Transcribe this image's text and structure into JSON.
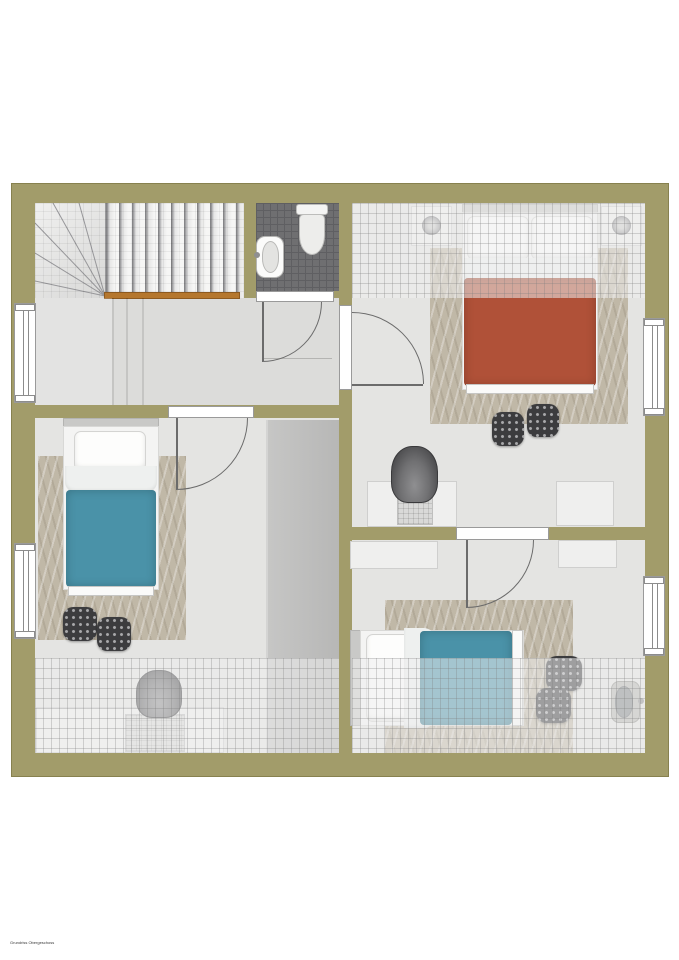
{
  "title": "floor-plan-upper-storey",
  "watermark_text": "Grundriss Obergeschoss",
  "colors": {
    "wall": "#a29c6a",
    "wall_outline": "#87814f",
    "floor": "#e4e4e2",
    "hallway_floor": "#dcdcda",
    "stair_shadow": "#77777a",
    "wood": "#b5772e",
    "bath_tile": "#6f6f71",
    "bath_tile_line": "#5f5f62",
    "rug": "#c0b8a7",
    "duvet_red": "#b05138",
    "duvet_blue": "#4a92a8",
    "pouf": "#3c3c3e",
    "pouf_dot": "#a8a8aa",
    "wardrobe": "#b7b7b6",
    "furniture_white": "#efefee",
    "furniture_border": "#cfcfce",
    "chair_dark": "#4c4c4e",
    "door_line": "#6b6b6b",
    "frame_border": "#9a9a9a",
    "lamp": "#9a9a9c",
    "hatch_veil": "rgba(238,238,238,0.55)",
    "hatch_line": "rgba(125,125,125,0.30)"
  },
  "plan": {
    "rooms": [
      {
        "name": "stairwell",
        "features": [
          "winder-staircase",
          "wood-edge-strip"
        ]
      },
      {
        "name": "bathroom",
        "features": [
          "washbasin",
          "toilet",
          "dark-tile-floor",
          "door-to-hallway"
        ]
      },
      {
        "name": "hallway",
        "features": [
          "window-left",
          "door-to-bathroom",
          "door-to-bedroom-right",
          "door-to-bedroom-left"
        ]
      },
      {
        "name": "bedroom-top-right",
        "features": [
          "double-bed-red",
          "nightstand-x2",
          "table-lamp-x2",
          "rug",
          "pouf-x2",
          "desk",
          "desk-chair",
          "dresser",
          "window-right",
          "roof-slope-hatch-top"
        ]
      },
      {
        "name": "bedroom-left",
        "features": [
          "single-bed-blue",
          "rug",
          "pouf-x2",
          "wardrobe",
          "desk",
          "desk-chair",
          "window-left",
          "roof-slope-hatch-bottom"
        ]
      },
      {
        "name": "bedroom-bottom-right",
        "features": [
          "single-bed-blue",
          "rug",
          "pouf-x2",
          "sideboard-x2",
          "small-washbasin",
          "window-right",
          "roof-slope-hatch-bottom"
        ]
      }
    ],
    "windows": 4,
    "interior_doors": 4
  }
}
